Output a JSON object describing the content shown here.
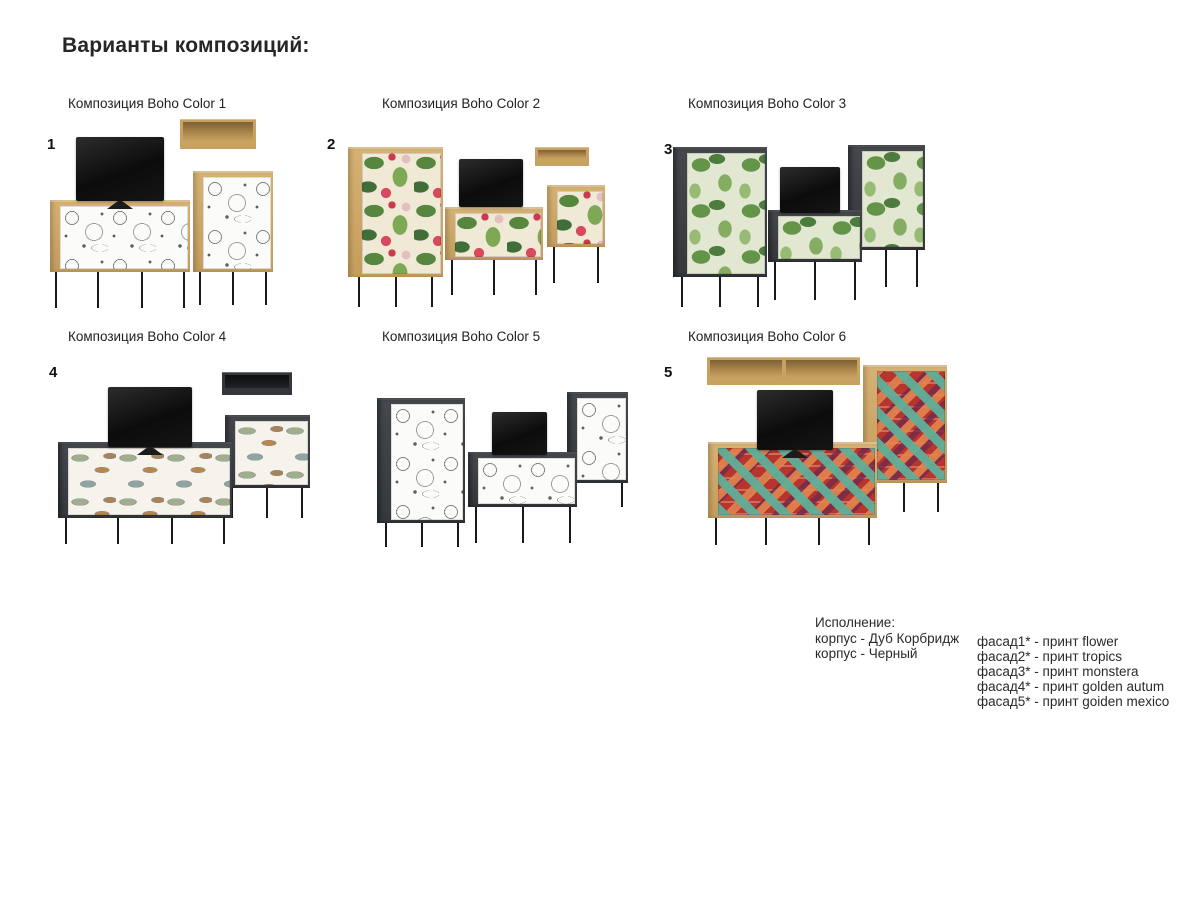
{
  "page": {
    "title": "Варианты композиций:"
  },
  "compositions": [
    {
      "label": "Композиция Boho Color 1",
      "number": "1",
      "print": "flower",
      "furniture": [
        "wall-shelf",
        "tv",
        "sideboard",
        "cabinet"
      ]
    },
    {
      "label": "Композиция Boho Color 2",
      "number": "2",
      "print": "tropics",
      "furniture": [
        "tall-cabinet",
        "tv",
        "sideboard",
        "wall-shelf",
        "cabinet"
      ]
    },
    {
      "label": "Композиция Boho Color 3",
      "number": "3",
      "print": "monstera",
      "furniture": [
        "tall-cabinet",
        "tv",
        "sideboard",
        "tall-cabinet"
      ]
    },
    {
      "label": "Композиция Boho Color 4",
      "number": "4",
      "print": "golden autum",
      "furniture": [
        "tv",
        "wall-shelf",
        "sideboard",
        "cabinet"
      ]
    },
    {
      "label": "Композиция Boho Color 5",
      "number": "",
      "print": "flower",
      "furniture": [
        "tall-cabinet",
        "tv",
        "sideboard",
        "tall-cabinet"
      ]
    },
    {
      "label": "Композиция Boho Color 6",
      "number": "5",
      "print": "goiden mexico",
      "furniture": [
        "wall-shelf",
        "tv",
        "sideboard",
        "tall-cabinet"
      ]
    }
  ],
  "legend": {
    "title": "Исполнение:",
    "body_lines": [
      "корпус - Дуб Корбридж",
      "корпус - Черный"
    ],
    "facade_lines": [
      "фасад1* - принт flower",
      "фасад2* - принт tropics",
      "фасад3* - принт monstera",
      "фасад4* - принт golden autum",
      "фасад5* - принт goiden mexico"
    ]
  },
  "colors": {
    "background": "#ffffff",
    "text": "#1f1f1f",
    "body_oak": "#c8a263",
    "body_black": "#3b3e42",
    "tv_black": "#101010",
    "legs": "#1a1a1a",
    "print_flower": [
      "#fbfbf9",
      "#2e2e2e"
    ],
    "print_tropics": [
      "#efe9d6",
      "#57873f",
      "#7fa855",
      "#d84a5b",
      "#e3bfc0"
    ],
    "print_monstera": [
      "#e2e7d2",
      "#649448",
      "#85ad62",
      "#4c7c3e"
    ],
    "print_golden_autum": [
      "#f6f3ec",
      "#9fae8d",
      "#b9874d",
      "#8da5a0"
    ],
    "print_goiden_mexico": [
      "#b8352e",
      "#5fae99",
      "#e2854f",
      "#72294a",
      "#e8d9b0"
    ]
  }
}
